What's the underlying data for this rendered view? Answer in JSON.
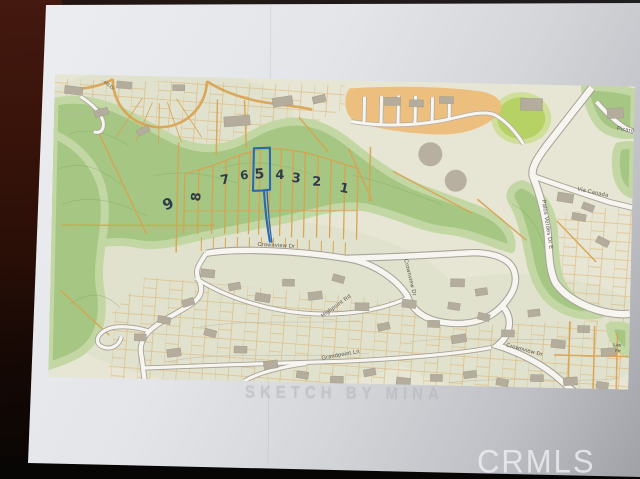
{
  "photo": {
    "watermark_label": "CRMLS",
    "pencil_note": "SKETCH BY MINA"
  },
  "map": {
    "highlighted_lot": "5",
    "lot_numbers": [
      "9",
      "8",
      "7",
      "6",
      "5",
      "4",
      "3",
      "2",
      "1"
    ],
    "streets": {
      "crownview_west": "Crownview Dr",
      "crownview_mid": "Crownview Dr",
      "crownview_southeast": "Crownview Dr",
      "highpoint": "Highpoint Rd",
      "grandpoint": "Grandpoint Ln",
      "palos_verdes": "Palos Verdes Dr E",
      "via_canada": "Via Canada",
      "picardo": "Picardo",
      "partial_top_left": "...eld Dr",
      "partial_right_line1": "Las",
      "partial_right_line2": "Fir"
    },
    "colors": {
      "open_space_green": "#a5c783",
      "bright_field_green": "#b6d164",
      "parcel_line_orange": "#d9a24f",
      "road_fill": "#f7f5f0",
      "map_background": "#e7e5d3",
      "annotation_blue": "#2c67b0",
      "handwriting_ink": "#2f3b49"
    }
  }
}
